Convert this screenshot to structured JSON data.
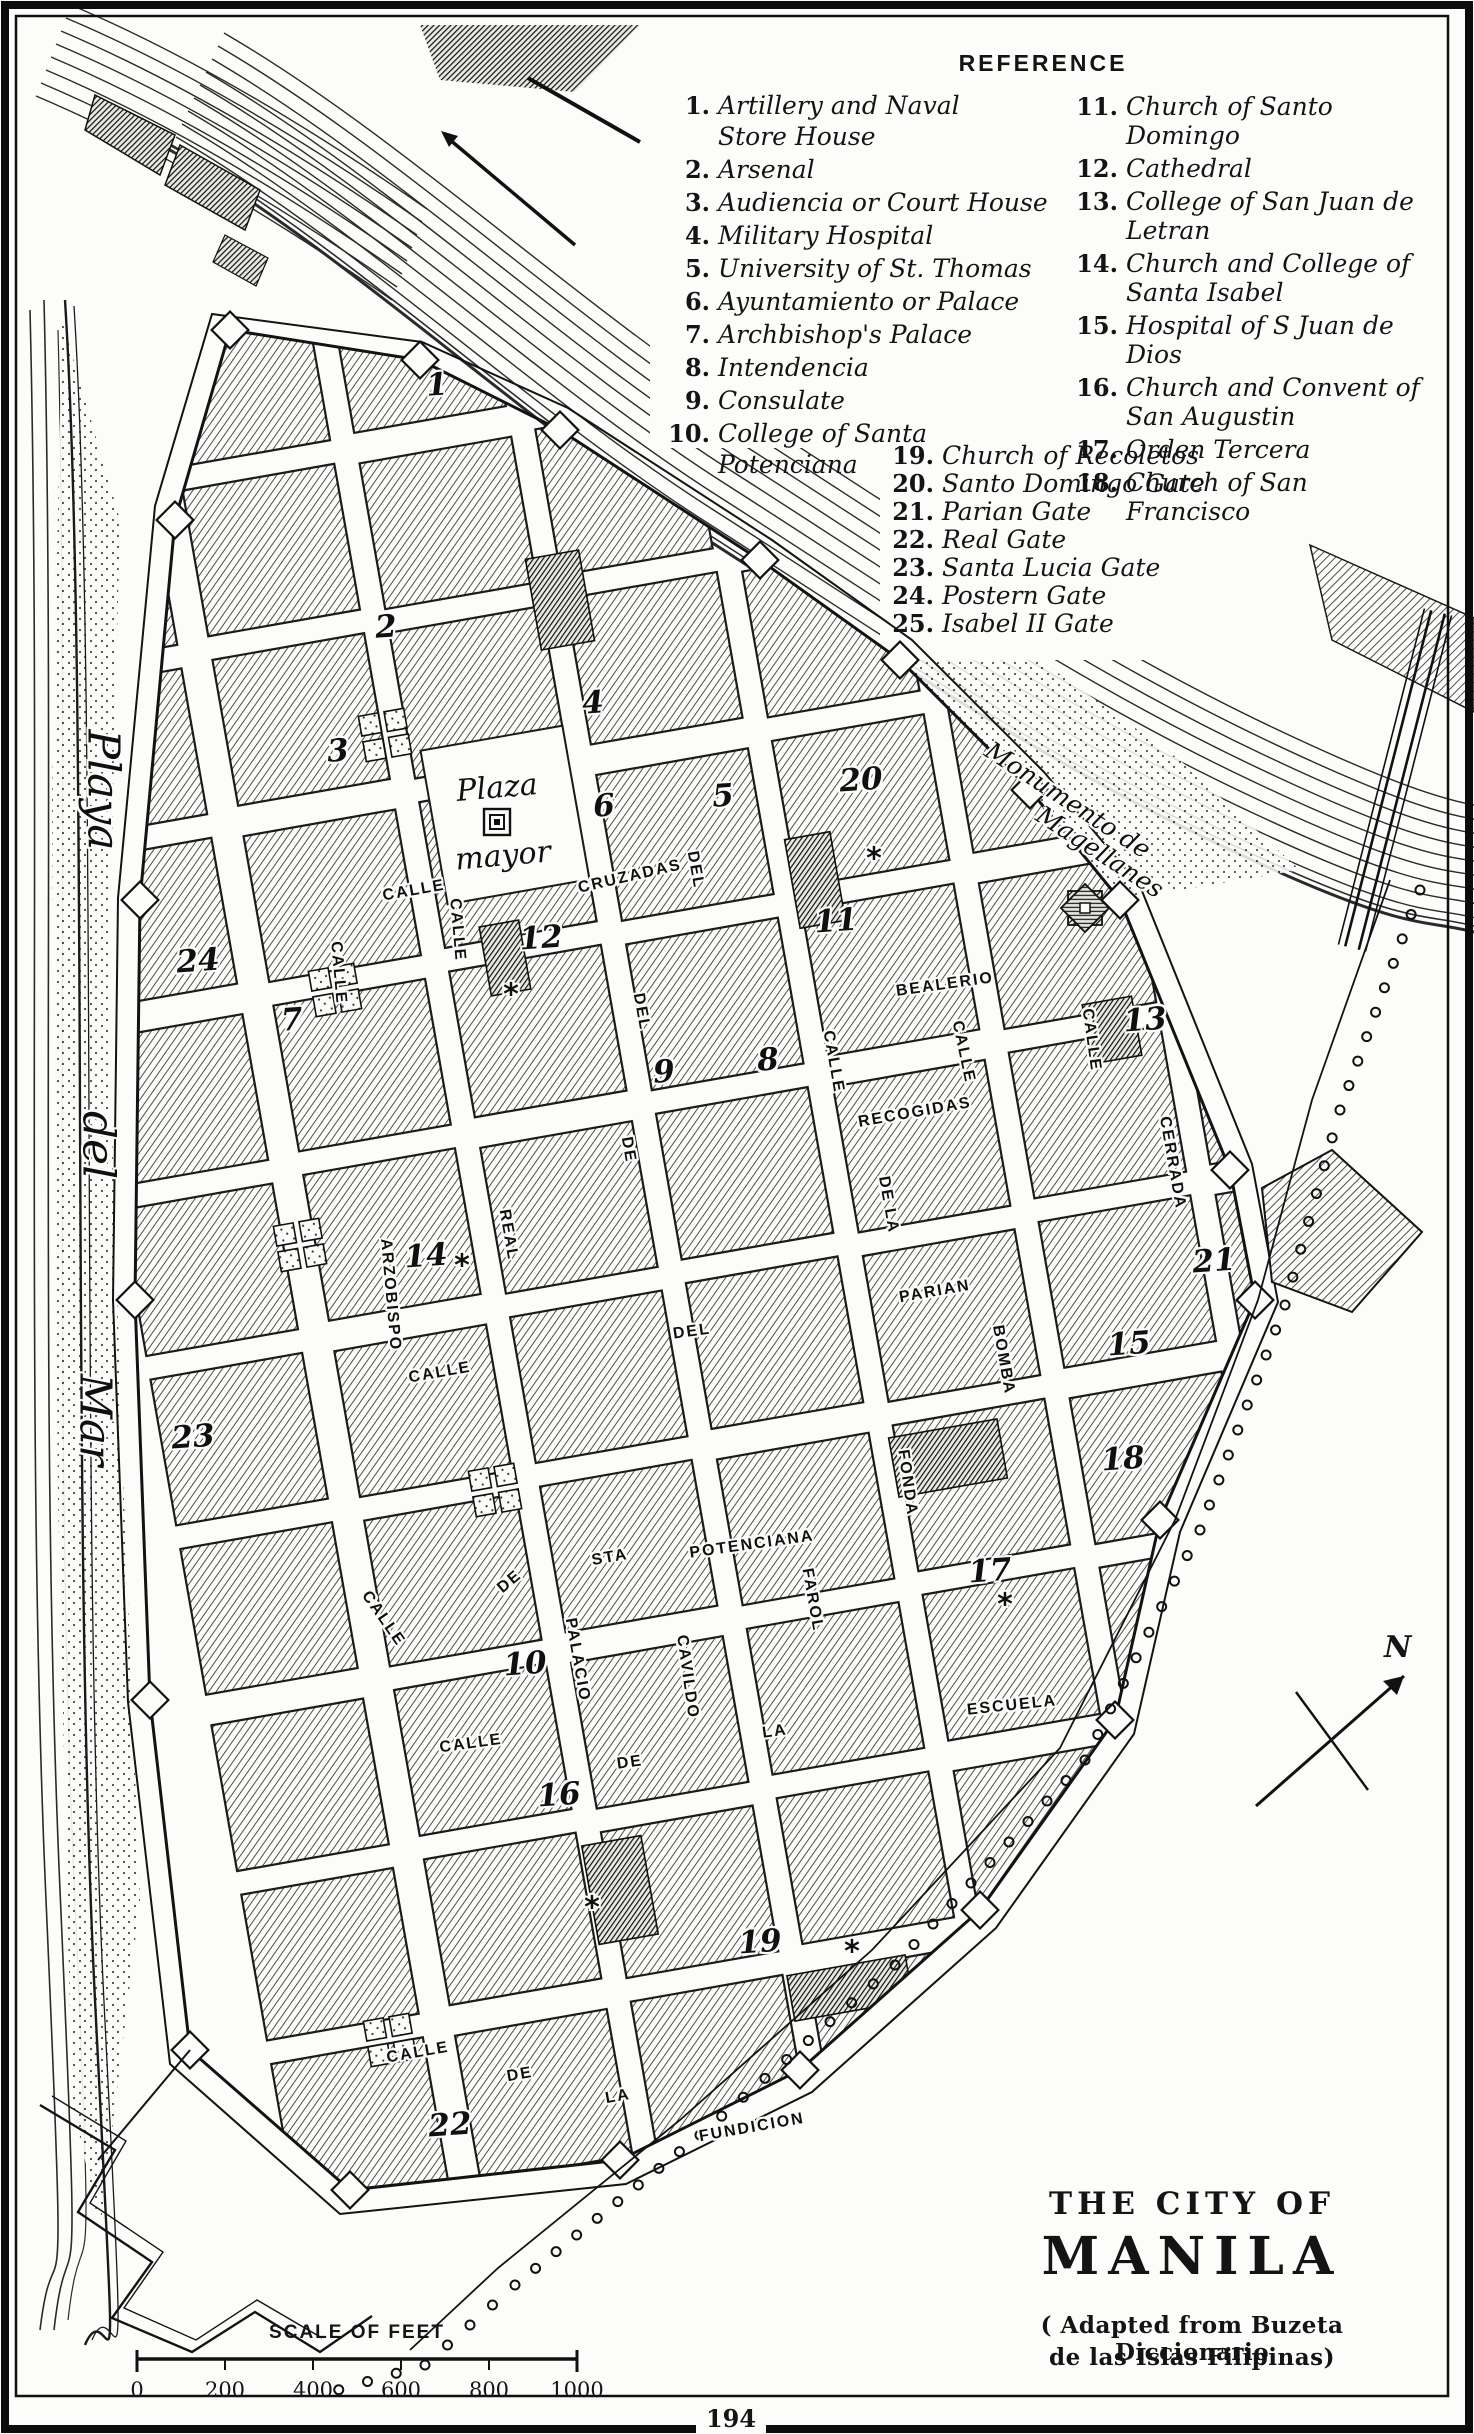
{
  "legend": {
    "title": "REFERENCE",
    "col1": [
      {
        "n": "1.",
        "t": "Artillery and Naval Store House"
      },
      {
        "n": "2.",
        "t": "Arsenal"
      },
      {
        "n": "3.",
        "t": "Audiencia or Court House"
      },
      {
        "n": "4.",
        "t": "Military Hospital"
      },
      {
        "n": "5.",
        "t": "University of St. Thomas"
      },
      {
        "n": "6.",
        "t": "Ayuntamiento or Palace"
      },
      {
        "n": "7.",
        "t": "Archbishop's Palace"
      },
      {
        "n": "8.",
        "t": "Intendencia"
      },
      {
        "n": "9.",
        "t": "Consulate"
      },
      {
        "n": "10.",
        "t": "College of Santa Potenciana"
      }
    ],
    "col2": [
      {
        "n": "11.",
        "t": "Church of Santo Domingo"
      },
      {
        "n": "12.",
        "t": "Cathedral"
      },
      {
        "n": "13.",
        "t": "College of San Juan de Letran"
      },
      {
        "n": "14.",
        "t": "Church and College of Santa Isabel"
      },
      {
        "n": "15.",
        "t": "Hospital of S Juan de Dios"
      },
      {
        "n": "16.",
        "t": "Church and Convent of San Augustin"
      },
      {
        "n": "17.",
        "t": "Orden Tercera"
      },
      {
        "n": "18.",
        "t": "Church of San Francisco"
      }
    ],
    "col3": [
      {
        "n": "19.",
        "t": "Church of Recoletos"
      },
      {
        "n": "20.",
        "t": "Santo Domingo Gate"
      },
      {
        "n": "21.",
        "t": "Parian Gate"
      },
      {
        "n": "22.",
        "t": "Real Gate"
      },
      {
        "n": "23.",
        "t": "Santa Lucia Gate"
      },
      {
        "n": "24.",
        "t": "Postern Gate"
      },
      {
        "n": "25.",
        "t": "Isabel II Gate"
      }
    ]
  },
  "map": {
    "street_labels": [
      {
        "t": "CRUZADAS",
        "x": 630,
        "y": 877,
        "r": -13
      },
      {
        "t": "BEALERIO",
        "x": 945,
        "y": 985,
        "r": -8
      },
      {
        "t": "RECOGIDAS",
        "x": 915,
        "y": 1113,
        "r": -10
      },
      {
        "t": "CALLE",
        "x": 833,
        "y": 1062,
        "r": 80
      },
      {
        "t": "CALLE",
        "x": 963,
        "y": 1052,
        "r": 78
      },
      {
        "t": "CALLE",
        "x": 1091,
        "y": 1040,
        "r": 82
      },
      {
        "t": "CERRADA",
        "x": 1172,
        "y": 1163,
        "r": 80
      },
      {
        "t": "DE LA",
        "x": 888,
        "y": 1205,
        "r": 80
      },
      {
        "t": "BOMBA",
        "x": 1003,
        "y": 1360,
        "r": 80
      },
      {
        "t": "PARIAN",
        "x": 935,
        "y": 1292,
        "r": -10
      },
      {
        "t": "FONDA",
        "x": 907,
        "y": 1483,
        "r": 82
      },
      {
        "t": "STA",
        "x": 610,
        "y": 1558,
        "r": -10
      },
      {
        "t": "POTENCIANA",
        "x": 752,
        "y": 1545,
        "r": -8
      },
      {
        "t": "PALACIO",
        "x": 577,
        "y": 1660,
        "r": 80
      },
      {
        "t": "CAVILDO",
        "x": 687,
        "y": 1677,
        "r": 82
      },
      {
        "t": "FAROL",
        "x": 812,
        "y": 1600,
        "r": 80
      },
      {
        "t": "DE",
        "x": 510,
        "y": 1582,
        "r": -40
      },
      {
        "t": "LA",
        "x": 775,
        "y": 1732,
        "r": -8
      },
      {
        "t": "ESCUELA",
        "x": 1012,
        "y": 1706,
        "r": -6
      },
      {
        "t": "CALLE",
        "x": 471,
        "y": 1744,
        "r": -8
      },
      {
        "t": "DE",
        "x": 630,
        "y": 1763,
        "r": -8
      },
      {
        "t": "CALLE",
        "x": 414,
        "y": 891,
        "r": -10
      },
      {
        "t": "CALLE",
        "x": 338,
        "y": 973,
        "r": 85
      },
      {
        "t": "CALLE",
        "x": 457,
        "y": 930,
        "r": 85
      },
      {
        "t": "ARZOBISPO",
        "x": 390,
        "y": 1295,
        "r": 85
      },
      {
        "t": "REAL",
        "x": 508,
        "y": 1235,
        "r": 80
      },
      {
        "t": "CALLE",
        "x": 440,
        "y": 1373,
        "r": -10
      },
      {
        "t": "DEL",
        "x": 692,
        "y": 1332,
        "r": -8
      },
      {
        "t": "DEL",
        "x": 695,
        "y": 870,
        "r": 80
      },
      {
        "t": "DEL",
        "x": 641,
        "y": 1012,
        "r": 80
      },
      {
        "t": "DE",
        "x": 628,
        "y": 1150,
        "r": 80
      },
      {
        "t": "CALLE",
        "x": 418,
        "y": 2053,
        "r": -10
      },
      {
        "t": "DE",
        "x": 520,
        "y": 2075,
        "r": -10
      },
      {
        "t": "LA",
        "x": 618,
        "y": 2097,
        "r": -10
      },
      {
        "t": "FUNDICION",
        "x": 752,
        "y": 2128,
        "r": -10
      },
      {
        "t": "CALLE",
        "x": 383,
        "y": 1619,
        "r": 55
      }
    ],
    "italic_labels": [
      {
        "t": "Plaza",
        "x": 497,
        "y": 788,
        "r": -5,
        "s": 30
      },
      {
        "t": "mayor",
        "x": 503,
        "y": 856,
        "r": -5,
        "s": 30
      },
      {
        "t": "Monumento de",
        "x": 1068,
        "y": 800,
        "r": 33,
        "s": 25
      },
      {
        "t": "Magellanes",
        "x": 1100,
        "y": 852,
        "r": 33,
        "s": 25
      },
      {
        "t": "Playa",
        "x": 103,
        "y": 790,
        "r": 90,
        "s": 44
      },
      {
        "t": "del",
        "x": 98,
        "y": 1145,
        "r": 90,
        "s": 44
      },
      {
        "t": "Mar",
        "x": 95,
        "y": 1420,
        "r": 90,
        "s": 44
      }
    ],
    "numbers": [
      {
        "n": "1",
        "x": 437,
        "y": 385
      },
      {
        "n": "2",
        "x": 386,
        "y": 627
      },
      {
        "n": "3",
        "x": 338,
        "y": 751
      },
      {
        "n": "4",
        "x": 593,
        "y": 703
      },
      {
        "n": "5",
        "x": 723,
        "y": 796
      },
      {
        "n": "6",
        "x": 604,
        "y": 806
      },
      {
        "n": "7",
        "x": 292,
        "y": 1020
      },
      {
        "n": "8",
        "x": 768,
        "y": 1060
      },
      {
        "n": "9",
        "x": 664,
        "y": 1072
      },
      {
        "n": "10",
        "x": 525,
        "y": 1664
      },
      {
        "n": "11",
        "x": 836,
        "y": 921
      },
      {
        "n": "12",
        "x": 541,
        "y": 938
      },
      {
        "n": "13",
        "x": 1145,
        "y": 1020
      },
      {
        "n": "14",
        "x": 426,
        "y": 1256
      },
      {
        "n": "15",
        "x": 1129,
        "y": 1344
      },
      {
        "n": "16",
        "x": 559,
        "y": 1795
      },
      {
        "n": "17",
        "x": 990,
        "y": 1571
      },
      {
        "n": "18",
        "x": 1123,
        "y": 1459
      },
      {
        "n": "19",
        "x": 760,
        "y": 1942
      },
      {
        "n": "20",
        "x": 861,
        "y": 780
      },
      {
        "n": "21",
        "x": 1214,
        "y": 1261
      },
      {
        "n": "22",
        "x": 450,
        "y": 2125
      },
      {
        "n": "23",
        "x": 193,
        "y": 1437
      },
      {
        "n": "24",
        "x": 198,
        "y": 961
      }
    ],
    "church_markers": [
      {
        "x": 511,
        "y": 995
      },
      {
        "x": 874,
        "y": 859
      },
      {
        "x": 462,
        "y": 1266
      },
      {
        "x": 592,
        "y": 1908
      },
      {
        "x": 852,
        "y": 1952
      },
      {
        "x": 1005,
        "y": 1605
      }
    ]
  },
  "compass": {
    "label": "N"
  },
  "scale": {
    "title": "SCALE OF FEET",
    "ticks": [
      "0",
      "200",
      "400",
      "600",
      "800",
      "1000"
    ]
  },
  "title_block": {
    "line1": "THE CITY OF",
    "line2": "MANILA",
    "credit1": "( Adapted from Buzeta Diccionario",
    "credit2": "de las Islas Filipinas)"
  },
  "page": {
    "number": "194"
  },
  "colors": {
    "ink": "#141414",
    "paper": "#fcfcfa"
  }
}
